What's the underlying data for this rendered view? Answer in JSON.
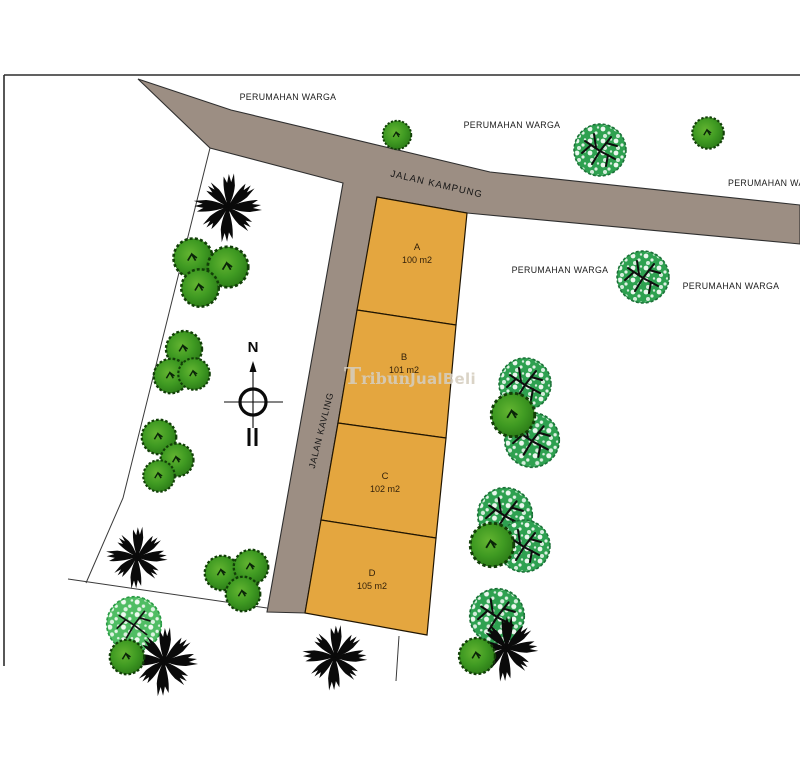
{
  "map": {
    "title_hint": "site plan of housing plots",
    "compass": {
      "north_label": "N"
    },
    "roads": [
      {
        "name": "JALAN KAMPUNG"
      },
      {
        "name": "JALAN KAVLING"
      }
    ],
    "surroundings": [
      {
        "label": "PERUMAHAN WARGA"
      },
      {
        "label": "PERUMAHAN WARGA"
      },
      {
        "label": "PERUMAHAN WARGA"
      },
      {
        "label": "PERUMAHAN WARGA"
      },
      {
        "label": "PERUMAHAN WARGA"
      }
    ],
    "plots": [
      {
        "id": "A",
        "area": "100 m2"
      },
      {
        "id": "B",
        "area": "101 m2"
      },
      {
        "id": "C",
        "area": "102 m2"
      },
      {
        "id": "D",
        "area": "105 m2"
      }
    ],
    "watermark": {
      "initial": "T",
      "serif_part": "ribun",
      "sans_part": "JualBeli"
    },
    "colors": {
      "road_fill": "#9c8e83",
      "road_outline": "#2f2f2f",
      "plot_fill": "#e4a63f",
      "plot_outline": "#201502",
      "plot_label": "#33210a",
      "map_text": "#1b1b1b",
      "bush_green": "#3f9a22",
      "tree_green": "#2ea150",
      "palm_black": "#0a0a0a",
      "watermark_gray": "#d5cdbf",
      "frame": "#2d2d2d"
    }
  }
}
